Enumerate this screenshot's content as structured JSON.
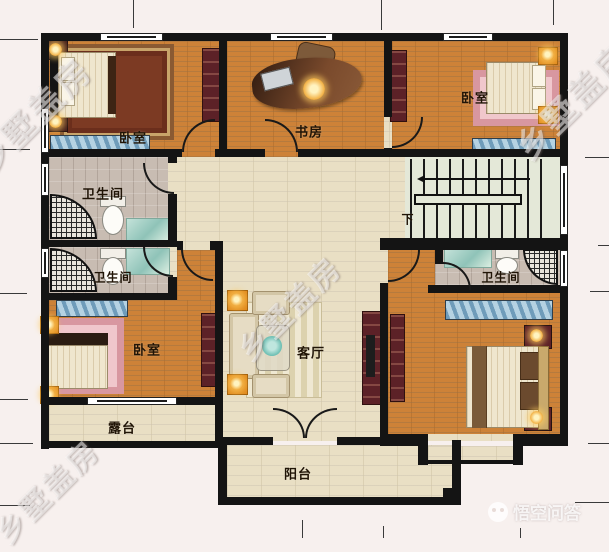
{
  "rooms": {
    "bedroom_top_left": {
      "label": "卧室"
    },
    "study": {
      "label": "书房"
    },
    "bedroom_top_right": {
      "label": "卧室"
    },
    "bathroom_upper_left": {
      "label": "卫生间"
    },
    "bathroom_lower_left": {
      "label": "卫生间"
    },
    "bathroom_right": {
      "label": "卫生间"
    },
    "bedroom_bottom_left": {
      "label": "卧室"
    },
    "living_room": {
      "label": "客厅"
    },
    "terrace": {
      "label": "露台"
    },
    "balcony": {
      "label": "阳台"
    },
    "staircase": {
      "direction_label": "下"
    }
  },
  "watermarks": {
    "diagonal_text": "乡墅盖房",
    "site_name": "悟空问答"
  },
  "colors": {
    "wall": "#141414",
    "wood_floor": "#cd8238",
    "tile_floor": "#e9dfc4",
    "bath_floor": "#c8bcb2",
    "stair_floor": "#e4e8d8",
    "lamp_accent": "#f3b44a",
    "rug_pink": "#e0a0a8",
    "bench_blue": "#8fb6d0"
  }
}
